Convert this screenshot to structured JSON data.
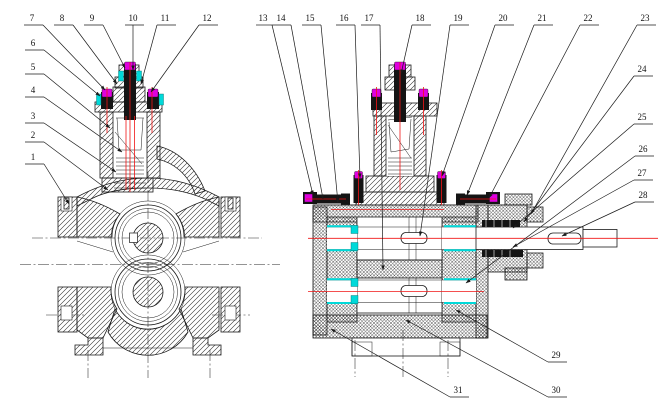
{
  "drawing": {
    "colors": {
      "background": "#ffffff",
      "line": "#1a1a1a",
      "centerline_red": "#f01414",
      "bearing_cyan": "#00d9d9",
      "fastener_magenta": "#df00df",
      "fastener_black": "#141414"
    },
    "callouts": [
      {
        "label": "1"
      },
      {
        "label": "2"
      },
      {
        "label": "3"
      },
      {
        "label": "4"
      },
      {
        "label": "5"
      },
      {
        "label": "6"
      },
      {
        "label": "7"
      },
      {
        "label": "8"
      },
      {
        "label": "9"
      },
      {
        "label": "10"
      },
      {
        "label": "11"
      },
      {
        "label": "12"
      },
      {
        "label": "13"
      },
      {
        "label": "14"
      },
      {
        "label": "15"
      },
      {
        "label": "16"
      },
      {
        "label": "17"
      },
      {
        "label": "18"
      },
      {
        "label": "19"
      },
      {
        "label": "20"
      },
      {
        "label": "21"
      },
      {
        "label": "22"
      },
      {
        "label": "23"
      },
      {
        "label": "24"
      },
      {
        "label": "25"
      },
      {
        "label": "26"
      },
      {
        "label": "27"
      },
      {
        "label": "28"
      },
      {
        "label": "29"
      },
      {
        "label": "30"
      },
      {
        "label": "31"
      }
    ]
  }
}
